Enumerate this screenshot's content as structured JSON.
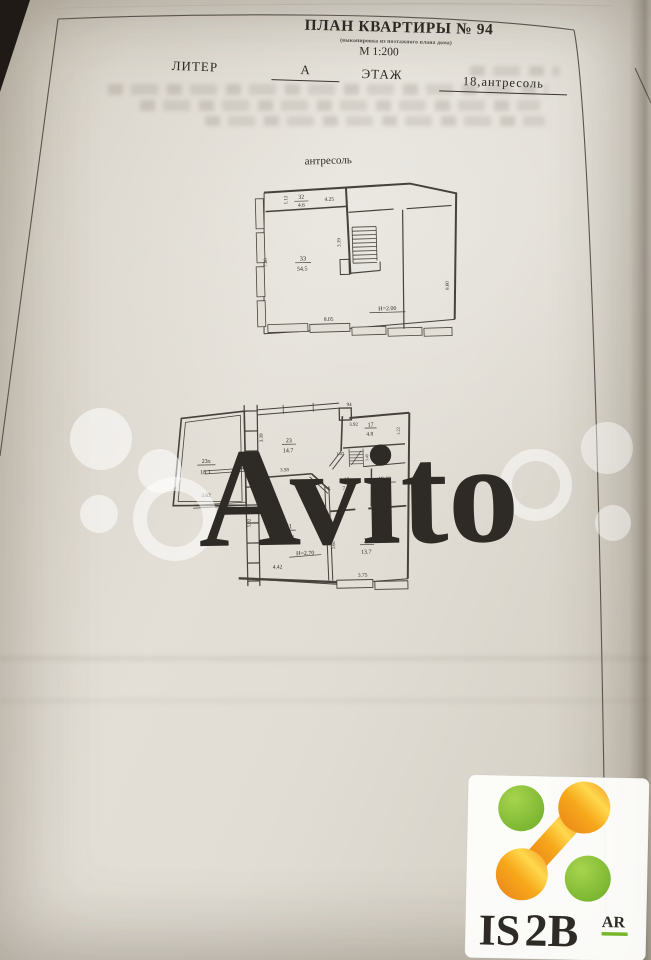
{
  "document": {
    "title": "ПЛАН КВАРТИРЫ № 94",
    "subtitle": "(выкопировка из поэтажного плана дома)",
    "scale": "М 1:200",
    "liter_label": "ЛИТЕР",
    "liter_value": "А",
    "floor_label": "ЭТАЖ",
    "floor_value": "18,антресоль"
  },
  "mezzanine": {
    "caption": "антресоль",
    "room32": {
      "number": "32",
      "area": "4.6"
    },
    "room33": {
      "number": "33",
      "area": "54.5"
    },
    "height_note": "Н=2.00",
    "dims": {
      "top_small": "1.12",
      "top_width": "4.25",
      "stairs": "3.19",
      "left_height": "7.20",
      "right_height": "8.60",
      "bottom_width": "8.05"
    }
  },
  "floor": {
    "room23x": {
      "number": "23х",
      "area": "18.1"
    },
    "room23": {
      "number": "23",
      "area": "14.7"
    },
    "room17": {
      "number": "17",
      "area": "4.8"
    },
    "room18": {
      "number": "18",
      "area": "7.0"
    },
    "room1920": {
      "number": "19-20",
      "area": "6.7"
    },
    "room21": {
      "number": "21",
      "area": "21.4"
    },
    "room22": {
      "number": "22",
      "area": "13.7"
    },
    "height_note": "Н=2.70",
    "dims": {
      "top_stub": "94",
      "r17_top": "3.92",
      "r17_right": "1.22",
      "col_left": "3.39",
      "r23_bottom": "3.58",
      "hall": "1.47",
      "stairs": "3.49",
      "r1920_bottom": "1.98",
      "r23x_bottom": "3.62",
      "r21_left": "5.02",
      "r21_bottom": "4.42",
      "r22_left": "3.66",
      "r22_bottom": "3.75"
    }
  },
  "watermark": {
    "text": "Avito"
  },
  "logo": {
    "part1": "IS",
    "part2": "2B",
    "part3": "AR",
    "green": "#76b82a",
    "orange": "#f7a81b"
  }
}
